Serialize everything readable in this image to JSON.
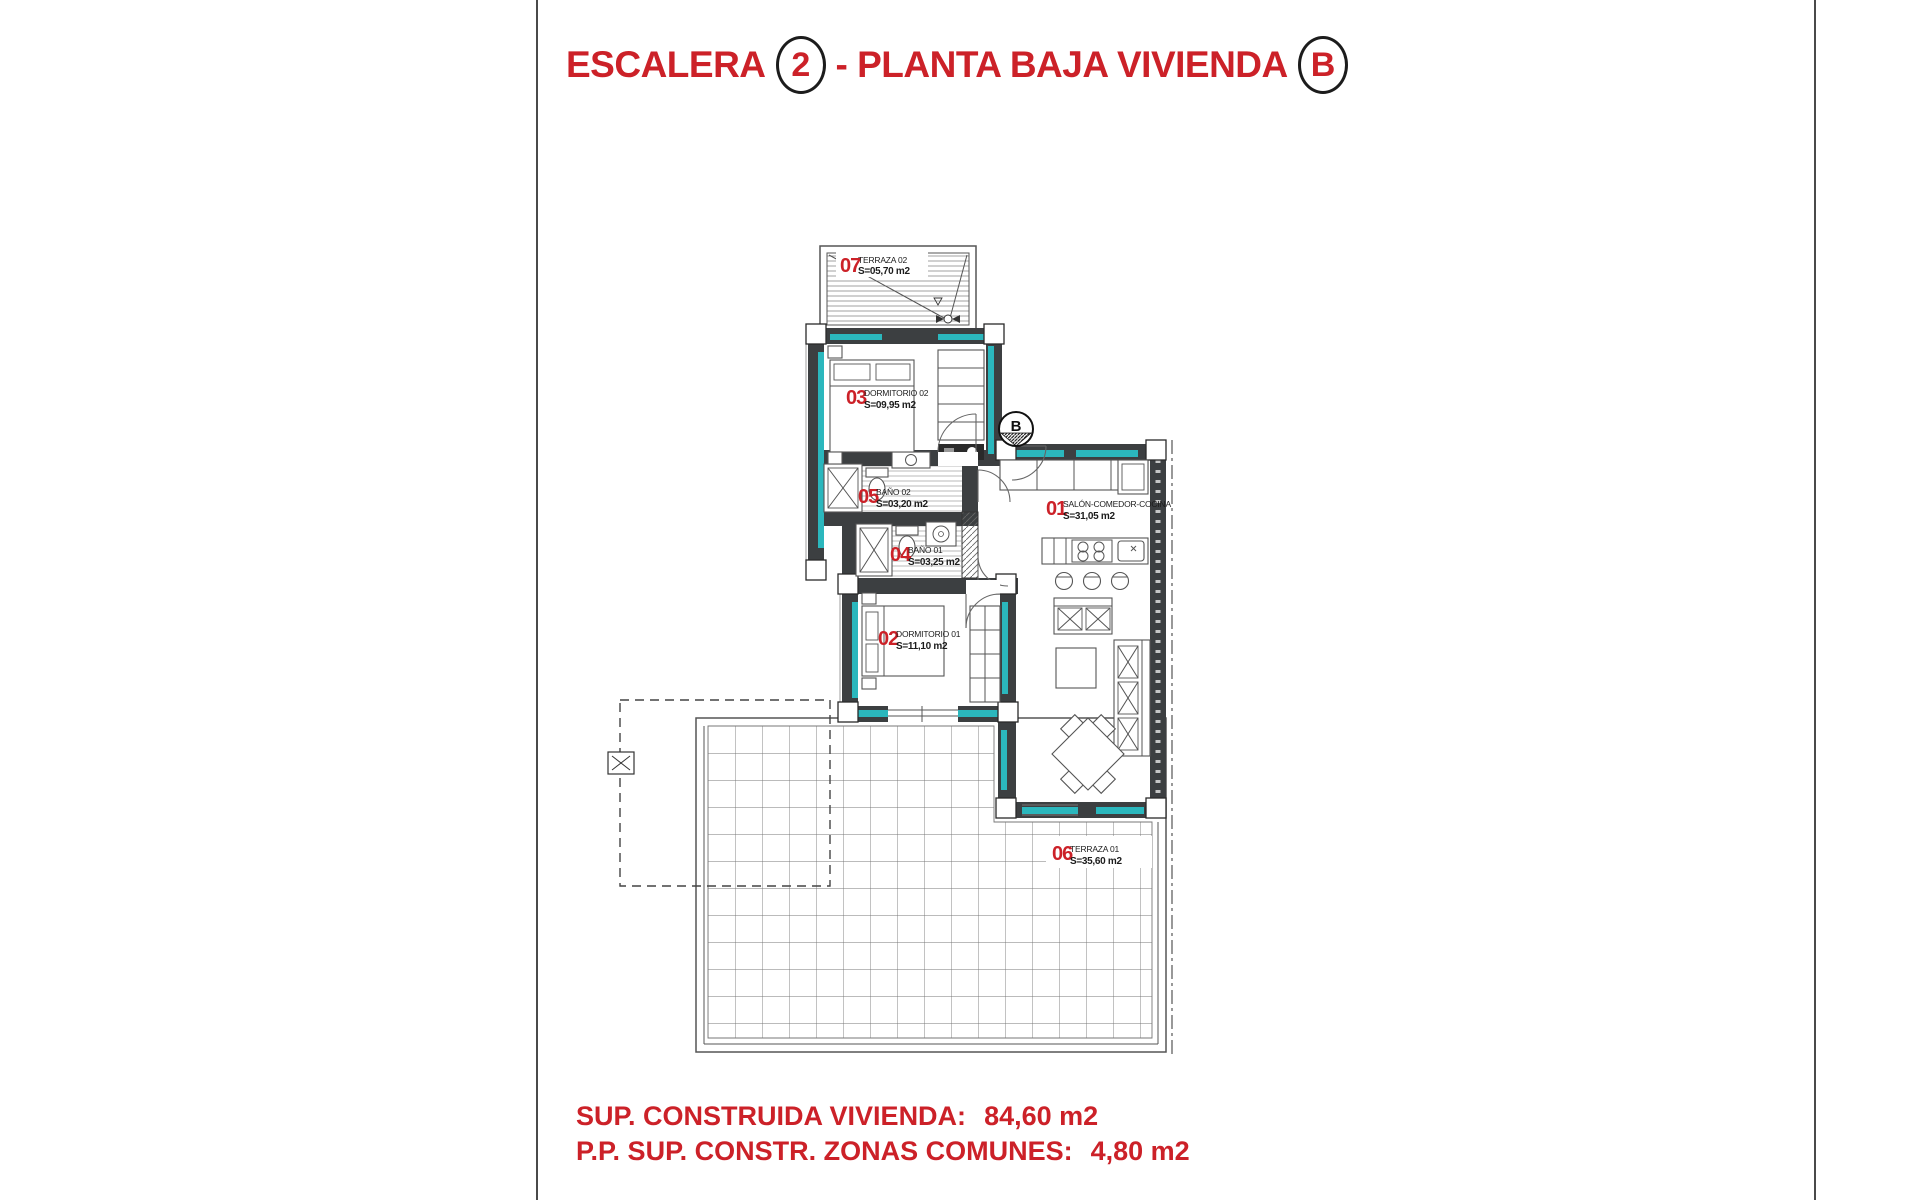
{
  "page": {
    "title": {
      "part1": "ESCALERA",
      "circle1": "2",
      "part2": "- PLANTA BAJA VIVIENDA",
      "circle2": "B"
    }
  },
  "summary": {
    "line1_label": "SUP. CONSTRUIDA VIVIENDA:",
    "line1_value": "84,60 m2",
    "line2_label": "P.P. SUP. CONSTR. ZONAS COMUNES:",
    "line2_value": "4,80 m2"
  },
  "plan": {
    "compass_label": "B",
    "rooms": [
      {
        "number": "01",
        "name": "SALÓN-COMEDOR-COCINA",
        "area": "S=31,05 m2"
      },
      {
        "number": "02",
        "name": "DORMITORIO 01",
        "area": "S=11,10 m2"
      },
      {
        "number": "03",
        "name": "DORMITORIO 02",
        "area": "S=09,95 m2"
      },
      {
        "number": "04",
        "name": "BAÑO 01",
        "area": "S=03,25 m2"
      },
      {
        "number": "05",
        "name": "BAÑO 02",
        "area": "S=03,20 m2"
      },
      {
        "number": "06",
        "name": "TERRAZA 01",
        "area": "S=35,60 m2"
      },
      {
        "number": "07",
        "name": "TERRAZA 02",
        "area": "S=05,70 m2"
      }
    ]
  },
  "colors": {
    "accent_red": "#cc2128",
    "wall_dark": "#3c3f41",
    "insulation_teal": "#2bb7bd",
    "line_gray": "#555555"
  }
}
